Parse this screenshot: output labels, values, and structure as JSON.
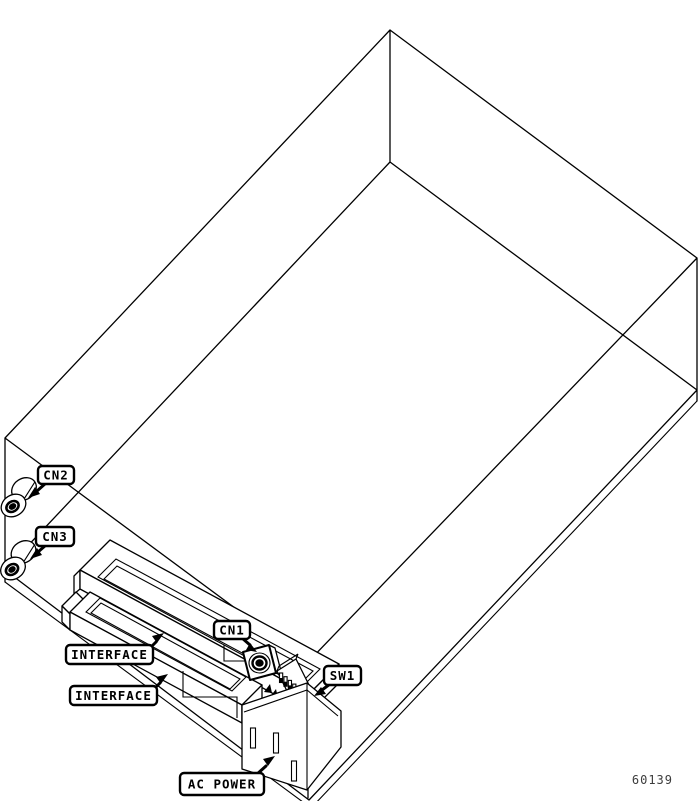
{
  "figure": {
    "number": "60139"
  },
  "callouts": {
    "cn2": "CN2",
    "cn3": "CN3",
    "cn1": "CN1",
    "sw1": "SW1",
    "interface_upper": "INTERFACE",
    "interface_lower": "INTERFACE",
    "ac_power": "AC POWER"
  },
  "components": {
    "cn2": "coaxial-connector",
    "cn3": "coaxial-connector",
    "cn1": "round-din-connector",
    "sw1": "dip-switch-6-position",
    "interface_upper": "card-edge-slot",
    "interface_lower": "card-edge-slot",
    "ac_power": "ac-outlet-3-slots"
  },
  "colors": {
    "line": "#000000",
    "background": "#ffffff",
    "figure_number": "#3c3c3c"
  }
}
